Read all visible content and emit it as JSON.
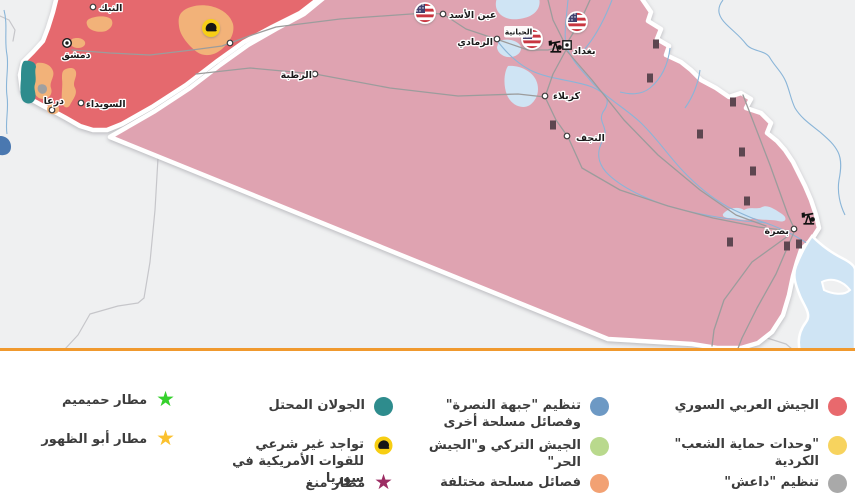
{
  "map": {
    "colors": {
      "background": "#eff0f1",
      "syria_government": "#e5696e",
      "iraq": "#dfa3b1",
      "opposition": "#f2b279",
      "golan": "#2e8c8d",
      "isis_pocket": "#a0a0a0",
      "water": "#cfe4f4",
      "river": "#8ab5d8",
      "dead_sea": "#4a78b0",
      "road": "#9c9c9c",
      "border_line": "#c6c6ca",
      "militia_marker": "#5d4650",
      "divider": "#f0992e",
      "flag_stripe": "#c8353f",
      "flag_canton": "#41416e",
      "helmet_badge": "#f7ce13"
    },
    "cities": {
      "nabk": "النبك",
      "damascus": "دمشق",
      "suwayda": "السويداء",
      "daraa": "درعا",
      "ain_al_asad": "عين الأسد",
      "ramadi": "الرمادي",
      "habbaniyah": "الحبانية",
      "baghdad": "بغداد",
      "rutba": "الرطبة",
      "karbala": "كربلاء",
      "najaf": "النجف",
      "basra": "بصرة"
    }
  },
  "legend": {
    "columns": [
      {
        "items": [
          {
            "type": "circle",
            "color": "#e8696d",
            "label": "الجيش العربي السوري"
          },
          {
            "type": "circle",
            "color": "#f7d35e",
            "label": "\"وحدات حماية الشعب\" الكردية"
          },
          {
            "type": "circle",
            "color": "#a9a9a9",
            "label": "تنظيم \"داعش\""
          }
        ]
      },
      {
        "items": [
          {
            "type": "circle",
            "color": "#6d99c4",
            "label": "تنظيم \"جبهة النصرة\" وفصائل مسلحة أخرى"
          },
          {
            "type": "circle",
            "color": "#b9d98d",
            "label": "الجيش التركي و\"الجيش الحر\""
          },
          {
            "type": "circle",
            "color": "#f2a173",
            "label": "فصائل مسلحة مختلفة"
          }
        ]
      },
      {
        "items": [
          {
            "type": "circle",
            "color": "#2e8c8d",
            "label": "الجولان المحتل"
          },
          {
            "type": "helmet",
            "color": "#f7ce13",
            "label": "تواجد غير شرعي للقوات الأمريكية في سوريا"
          },
          {
            "type": "star",
            "color": "#9c2d63",
            "glyph": "★",
            "label": "مطار منغ"
          }
        ]
      },
      {
        "items": [
          {
            "type": "star",
            "color": "#35d12c",
            "glyph": "★",
            "label": "مطار حميميم"
          },
          {
            "type": "star",
            "color": "#fbc12e",
            "glyph": "★",
            "label": "مطار أبو الظهور"
          }
        ]
      }
    ]
  }
}
